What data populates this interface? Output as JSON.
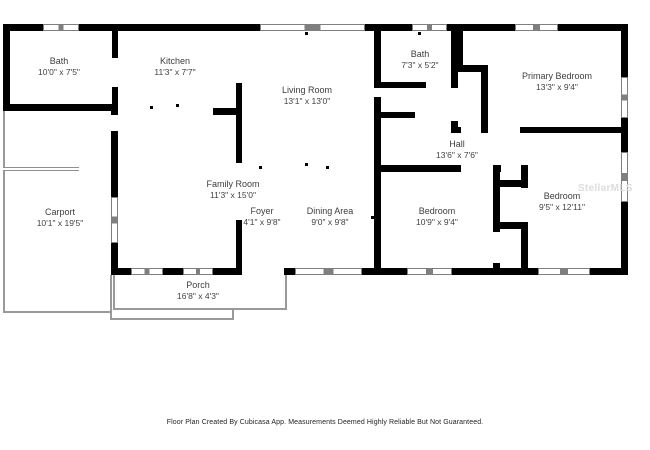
{
  "plan_title": "Floor Plan",
  "rooms": [
    {
      "name": "Bath",
      "dims": "10'0\" x 7'5\""
    },
    {
      "name": "Kitchen",
      "dims": "11'3\" x 7'7\""
    },
    {
      "name": "Living Room",
      "dims": "13'1\" x 13'0\""
    },
    {
      "name": "Bath",
      "dims": "7'3\" x 5'2\""
    },
    {
      "name": "Primary Bedroom",
      "dims": "13'3\" x 9'4\""
    },
    {
      "name": "Hall",
      "dims": "13'6\" x 7'6\""
    },
    {
      "name": "Family Room",
      "dims": "11'3\" x 15'0\""
    },
    {
      "name": "Carport",
      "dims": "10'1\" x 19'5\""
    },
    {
      "name": "Foyer",
      "dims": "4'1\" x 9'8\""
    },
    {
      "name": "Dining Area",
      "dims": "9'0\" x 9'8\""
    },
    {
      "name": "Bedroom",
      "dims": "10'9\" x 9'4\""
    },
    {
      "name": "Bedroom",
      "dims": "9'5\" x 12'11\""
    },
    {
      "name": "Porch",
      "dims": "16'8\" x 4'3\""
    }
  ],
  "footer": {
    "disclaimer": "Floor Plan Created By Cubicasa App. Measurements Deemed Highly Reliable But Not Guaranteed."
  },
  "watermark": {
    "text": "StellarMLS"
  },
  "colors": {
    "wall": "#000000",
    "thin_wall": "#9a9a9a",
    "window_line": "#7f7f7f",
    "label_text": "#3d3d3d",
    "watermark_text": "#dcdcdc"
  }
}
